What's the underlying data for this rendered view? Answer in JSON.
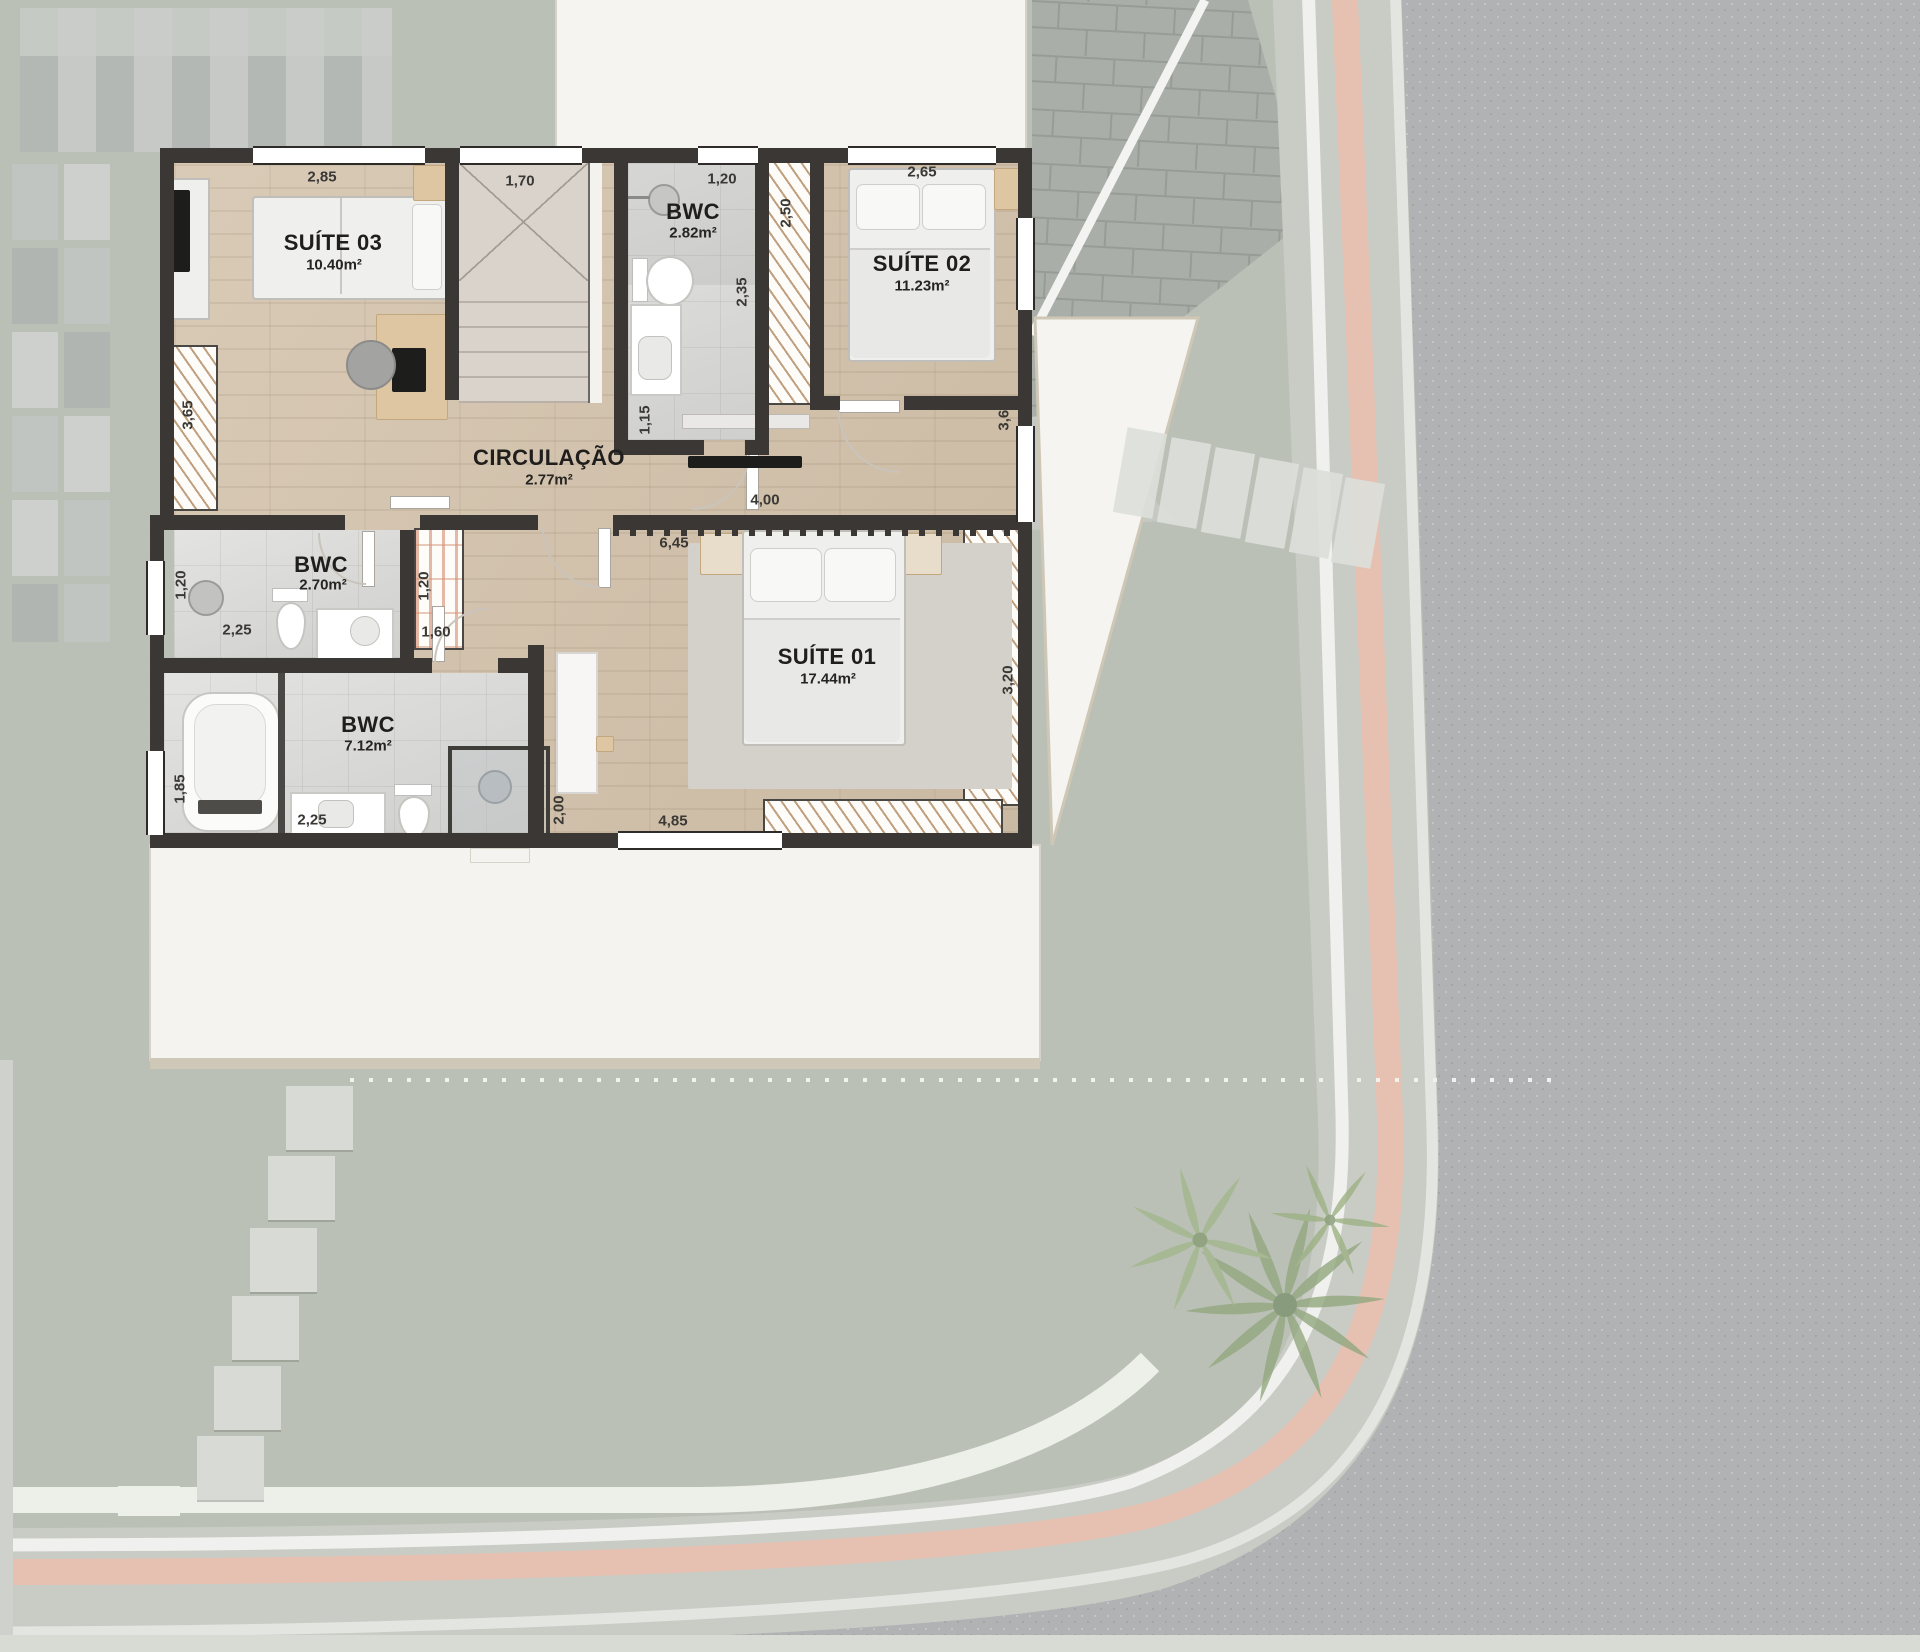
{
  "floorplan": {
    "rooms": {
      "suite03": {
        "name": "SUÍTE 03",
        "area": "10.40m²"
      },
      "bwc_top": {
        "name": "BWC",
        "area": "2.82m²"
      },
      "suite02": {
        "name": "SUÍTE 02",
        "area": "11.23m²"
      },
      "circulacao": {
        "name": "CIRCULAÇÃO",
        "area": "2.77m²"
      },
      "bwc_mid": {
        "name": "BWC",
        "area": "2.70m²"
      },
      "bwc_suite01": {
        "name": "BWC",
        "area": "7.12m²"
      },
      "suite01": {
        "name": "SUÍTE 01",
        "area": "17.44m²"
      }
    },
    "dims": {
      "suite03_top": "2,85",
      "stairs_top": "1,70",
      "bwc_top_width": "1,20",
      "suite02_top": "2,65",
      "closet_suite02": "2,50",
      "bwc_top_depth": "2,35",
      "suite03_closet": "3,65",
      "bwc_top_door": "1,15",
      "hall_right": "4,00",
      "suite02_side": "3,65",
      "hall_span": "6,45",
      "bwc_mid_window": "1,20",
      "bwc_mid_width": "2,25",
      "closet_hall_depth": "1,20",
      "closet_hall_width": "1,60",
      "suite01_closet": "3,20",
      "bwc_suite01_window": "1,85",
      "bwc_suite01_width": "2,25",
      "suite01_door_side": "2,00",
      "suite01_bottom": "4,85"
    },
    "colors": {
      "wall": "#3b3734",
      "wood_floor": "#d3c2ab",
      "bath_tile": "#dadad8",
      "lawn": "#bcc1b6",
      "sidewalk": "#c9cbc5",
      "tactile_strip": "#e6c0b1",
      "asphalt": "#b1b2b4",
      "paver": "#a8aca6",
      "roof_white": "#f5f4f1",
      "roof_edge": "#cfc7b6",
      "closet_hatch": "#b08860"
    }
  }
}
